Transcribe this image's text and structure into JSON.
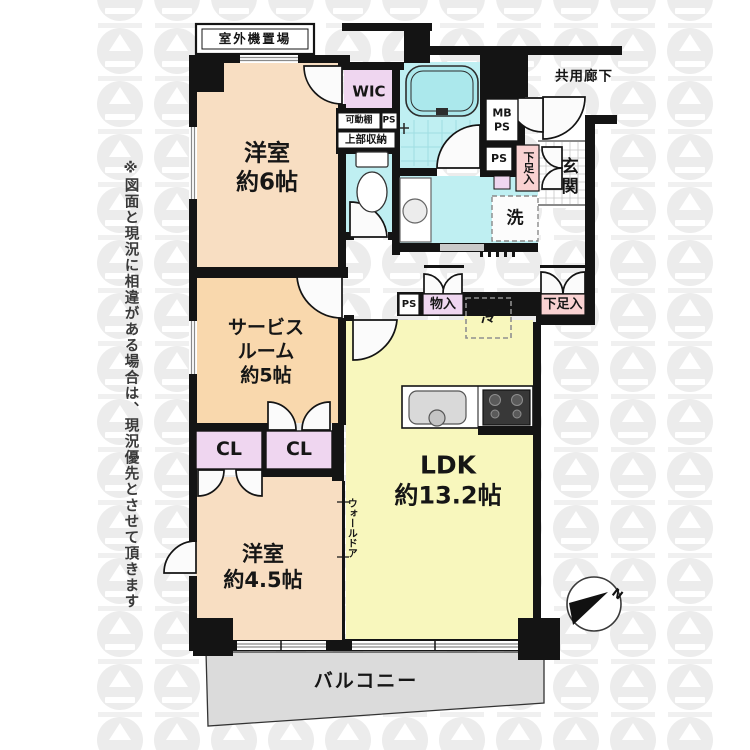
{
  "accent_colors": {
    "room_peach": "#F8DEC2",
    "service_peach": "#F9D8AD",
    "ldk_yellow": "#F8F7BD",
    "wet_cyan": "#BFEFF2",
    "closet_lavender": "#EFD6F0",
    "shoe_pink": "#F9D2D2",
    "balcony_gray": "#DBDBDB",
    "wall_black": "#141414"
  },
  "labels": {
    "disclaimer": "※図面と現況に相違がある場合は、現況優先とさせて頂きます",
    "outdoor_unit": "室外機置場",
    "common_corridor": "共用廊下",
    "bedroom6_name": "洋室",
    "bedroom6_size": "約6帖",
    "wic": "WIC",
    "movable_shelf": "可動棚",
    "ps_shelf": "PS",
    "upper_storage": "上部収納",
    "mb_line1": "MB",
    "mb_line2": "PS",
    "ps_entrance": "PS",
    "shoe_box_entrance": "下足入",
    "entrance": "玄関",
    "laundry": "洗",
    "service_room_line1": "サービス",
    "service_room_line2": "ルーム",
    "service_room_line3": "約5帖",
    "ps_corridor": "PS",
    "storage": "物入",
    "fridge": "冷",
    "shoe_box_ldk": "下足入",
    "closet_left": "CL",
    "closet_right": "CL",
    "ldk_name": "LDK",
    "ldk_size": "約13.2帖",
    "wall_door": "ウォールドア",
    "bedroom45_name": "洋室",
    "bedroom45_size": "約4.5帖",
    "balcony": "バルコニー",
    "compass_north": "N"
  }
}
